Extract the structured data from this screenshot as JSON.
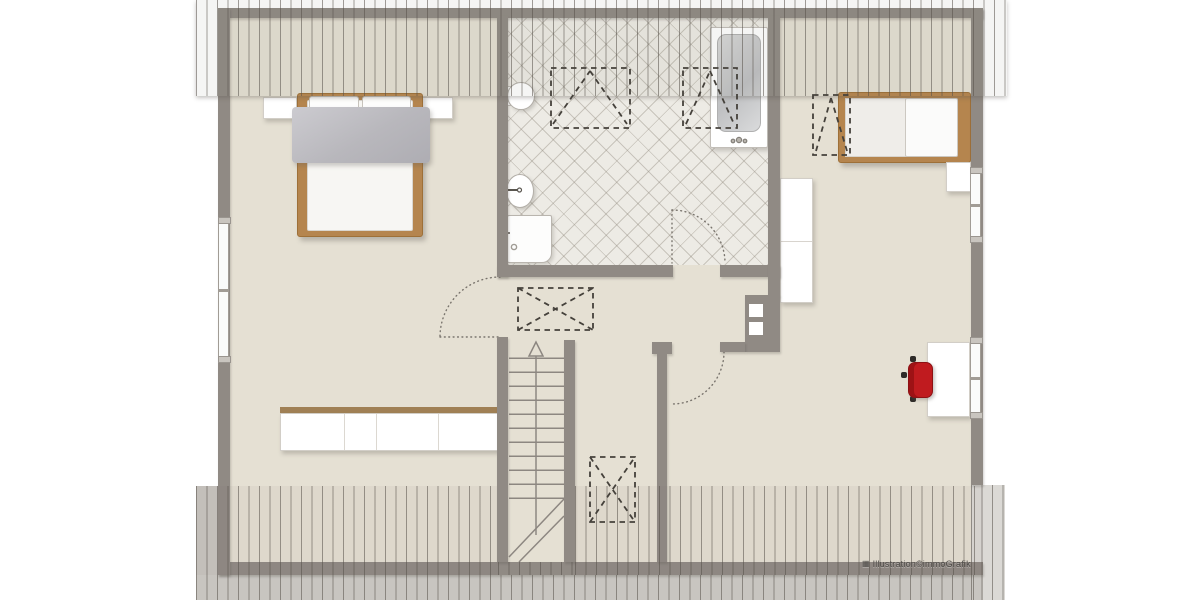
{
  "watermark": {
    "icon": "▦",
    "text": "Illustration©immoGrafik"
  },
  "colors": {
    "floor": "#e5e0d3",
    "wall": "#908a84",
    "wood": "#b5854e",
    "wood_dark": "#9e7038",
    "tile_bg": "#edebe5",
    "overhang": "#c8c5c0",
    "gable_light": "#dbd9d5",
    "chair_red": "#c01b1f",
    "furniture_white": "#ffffff",
    "furniture_border": "#d2cec7",
    "window_white": "#fafbfa",
    "watermark": "#4f4c48",
    "dash_line": "#45413b",
    "door_arc": "#79746d",
    "stair_line": "#8d8781"
  }
}
